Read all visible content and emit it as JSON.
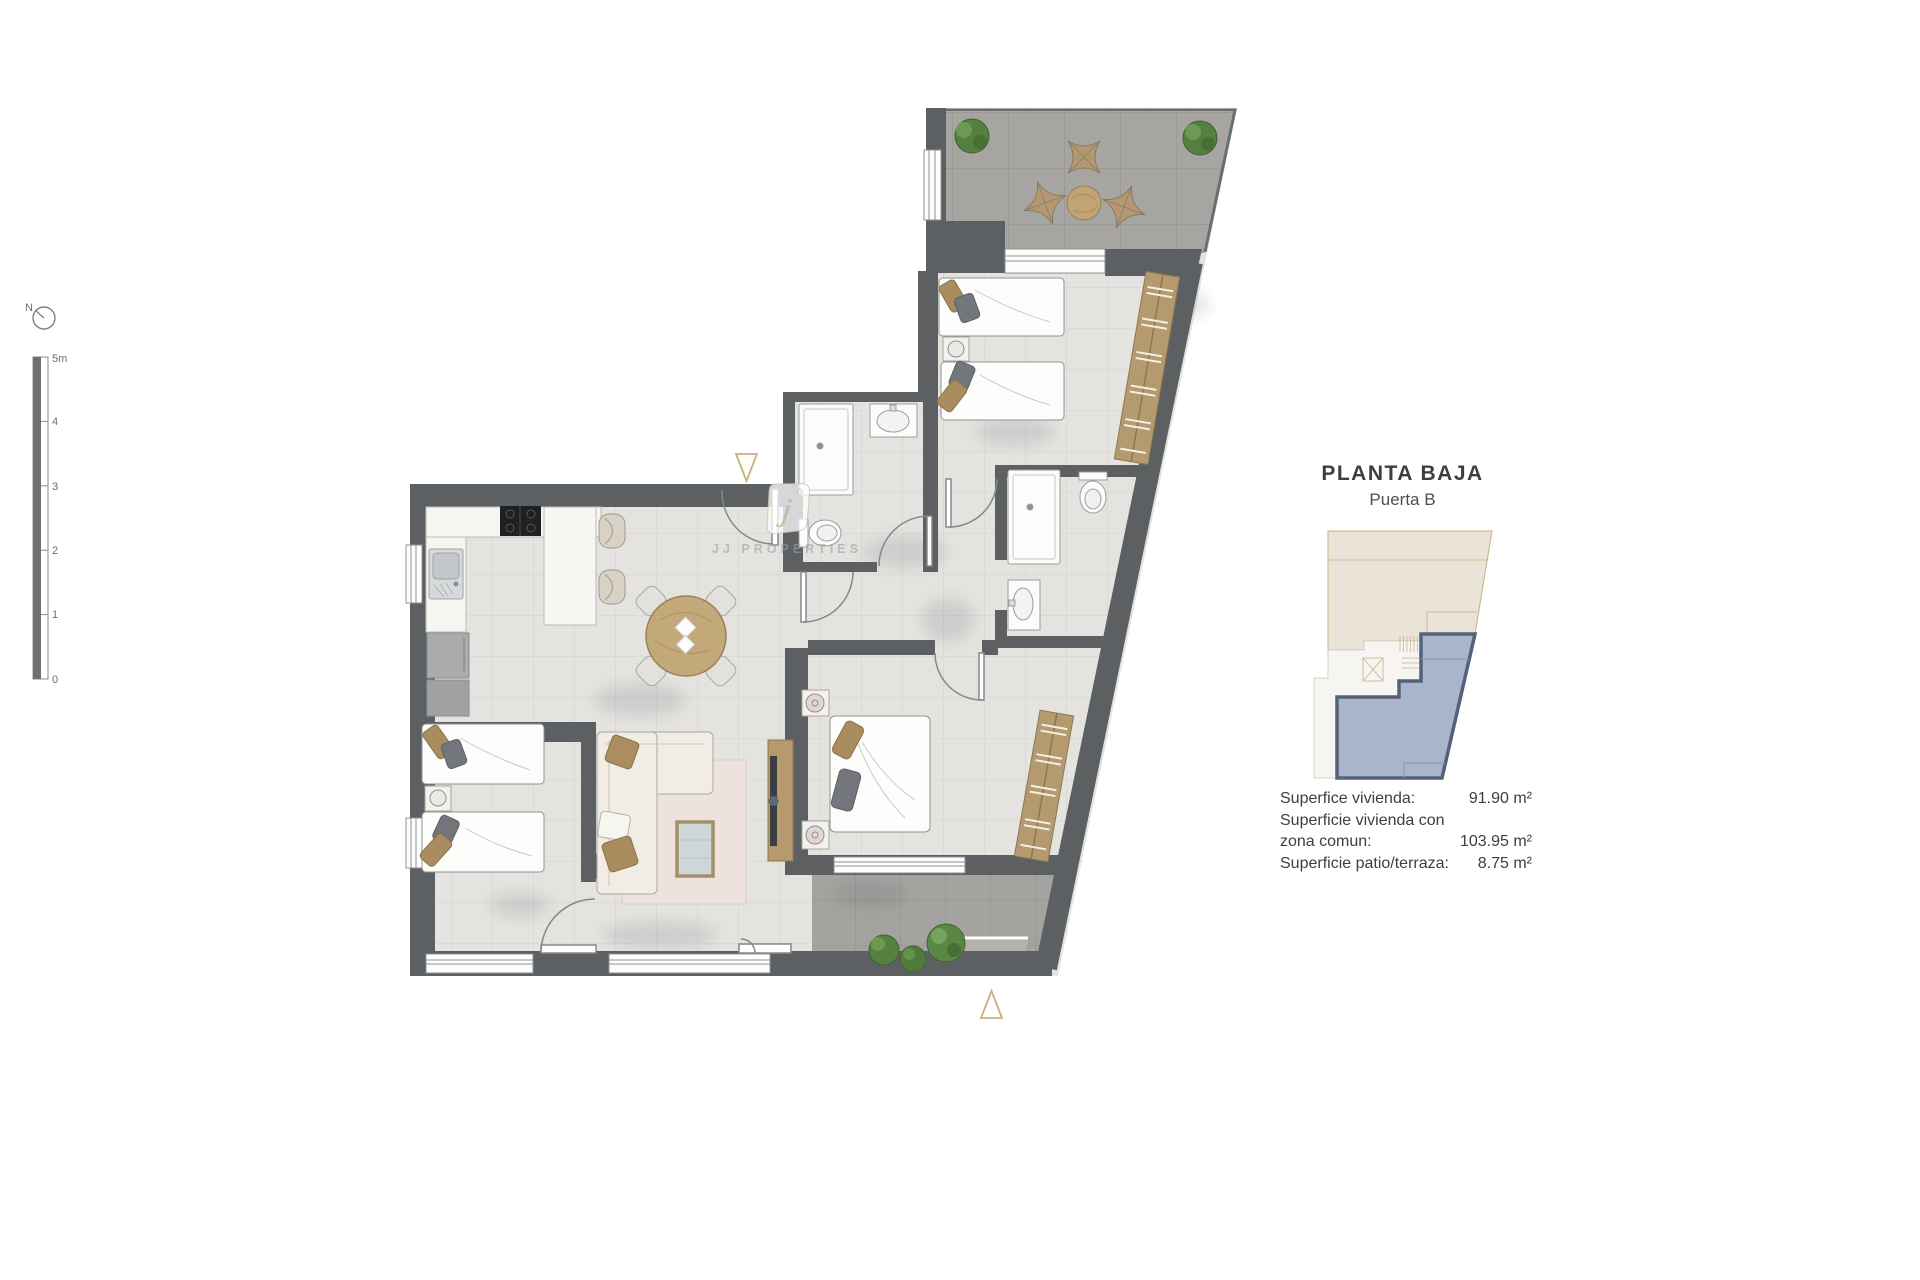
{
  "plan": {
    "watermark": {
      "letter": "j",
      "text": "JJ PROPERTIES"
    },
    "compass": {
      "label": "N"
    },
    "scale_bar": {
      "labels": [
        "5m",
        "4",
        "3",
        "2",
        "1",
        "0"
      ]
    }
  },
  "panel": {
    "title": "PLANTA BAJA",
    "subtitle": "Puerta B",
    "area_lines": [
      {
        "label": "Superfice vivienda:",
        "value": "91.90 m²"
      },
      {
        "label": "Superficie vivienda con",
        "value": ""
      },
      {
        "label": "zona comun:",
        "value": "103.95 m²"
      },
      {
        "label": "Superficie patio/terraza:",
        "value": "8.75 m²"
      }
    ]
  },
  "colors": {
    "wall": "#5d6063",
    "floor": "#e4e3e0",
    "floor_line": "#d2d1cd",
    "terrace_floor": "#a7a5a1",
    "terrace_line": "#96948f",
    "wood": "#b49a6e",
    "marker_tan": "#c9b07e",
    "minimap_unit": "#aab5cb",
    "minimap_unit_border": "#54617c",
    "minimap_building": "#e9e3d8",
    "minimap_outline": "#c8b086",
    "text": "#3c4043"
  }
}
